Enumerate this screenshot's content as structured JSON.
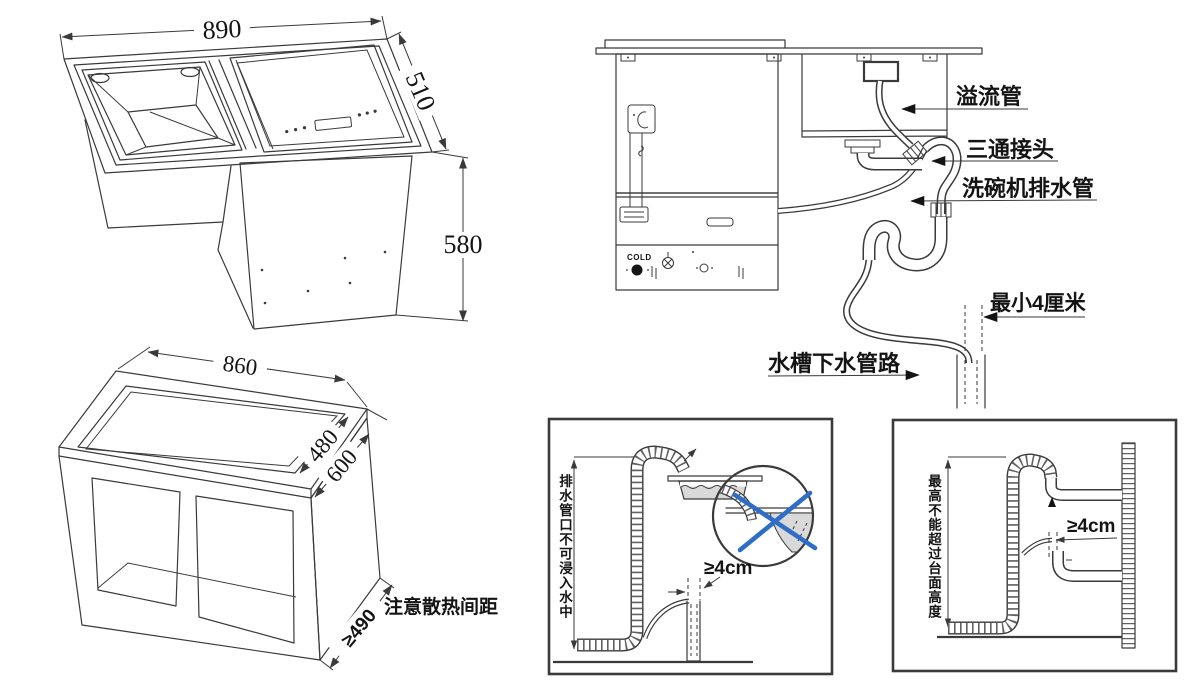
{
  "colors": {
    "line": "#3a3a3a",
    "label": "#141414",
    "cross_blue": "#2e6ec6",
    "water_gray": "#d9d9d9"
  },
  "iso_unit": {
    "dim_width": "890",
    "dim_depth": "510",
    "dim_height": "580"
  },
  "cabinet": {
    "dim_top": "860",
    "dim_inner_depth": "480",
    "dim_outer_depth": "600",
    "dim_clearance": "≥490",
    "note": "注意散热间距"
  },
  "plumbing": {
    "overflow_label": "溢流管",
    "tee_label": "三通接头",
    "dishwasher_drain_label": "洗碗机排水管",
    "sink_drain_label": "水槽下水管路",
    "min_gap_label": "最小4厘米",
    "cold_label": "COLD"
  },
  "drain_port_box": {
    "vertical_note": "排水管口不可浸入水中",
    "gap_label": "≥4cm"
  },
  "height_limit_box": {
    "vertical_note": "最高不能超过台面高度",
    "gap_label": "≥4cm"
  }
}
